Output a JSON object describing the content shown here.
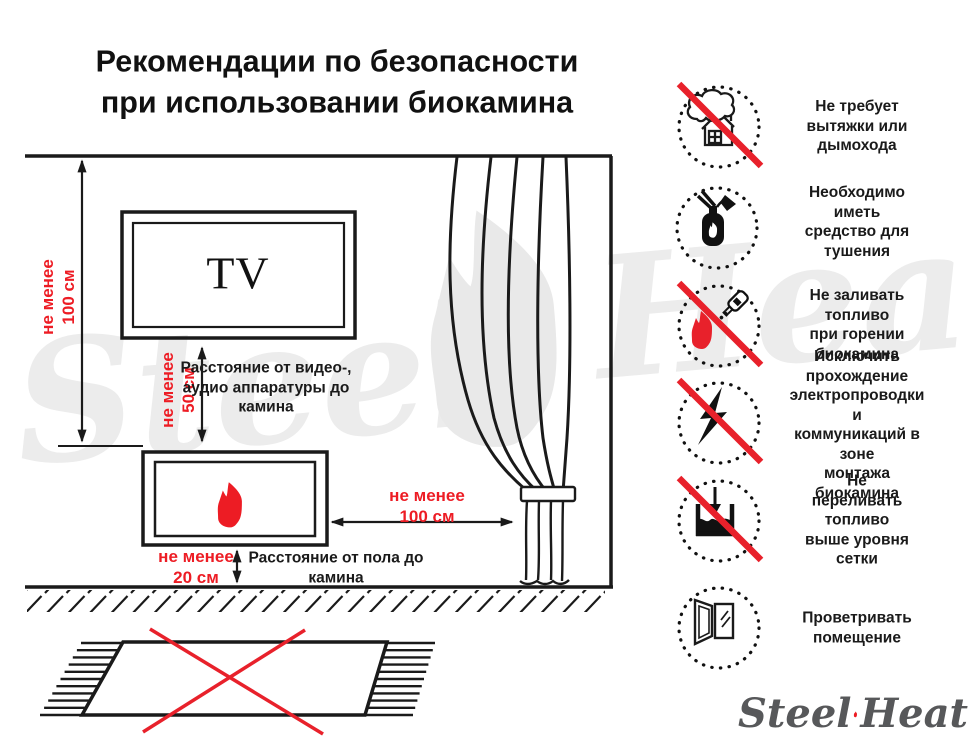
{
  "title": {
    "line1": "Рекомендации по безопасности",
    "line2": "при использовании биокамина"
  },
  "diagram": {
    "tv_label": "TV",
    "dim_wall_top": "не менее\n100 см",
    "dim_tv_gap": "не менее\n50 см",
    "caption_tv_gap": "Расстояние от видео-,\nаудио аппаратуры до\nкамина",
    "dim_curtain_gap": "не менее\n100 см",
    "dim_floor_gap": "не менее\n20 см",
    "caption_floor_gap": "Расстояние от пола до\nкамина"
  },
  "rules": [
    {
      "icon": "no-chimney-icon",
      "crossed": true,
      "text": "Не требует\nвытяжки или дымохода"
    },
    {
      "icon": "extinguisher-icon",
      "crossed": false,
      "text": "Необходимо иметь\nсредство для тушения"
    },
    {
      "icon": "no-refill-while-burning-icon",
      "crossed": true,
      "text": "Не заливать топливо\nпри горении биокамина"
    },
    {
      "icon": "no-wiring-icon",
      "crossed": true,
      "text": "Исключить прохождение\nэлектропроводки и\nкоммуникаций в зоне\nмонтажа биокамина"
    },
    {
      "icon": "no-overfill-icon",
      "crossed": true,
      "text": "Не переливать топливо\nвыше уровня сетки"
    },
    {
      "icon": "ventilate-icon",
      "crossed": false,
      "text": "Проветривать\nпомещение"
    }
  ],
  "watermark": {
    "steel": "Steel",
    "heat": "Heat"
  },
  "logo": {
    "steel": "Steel",
    "heat": "Heat"
  },
  "colors": {
    "red_accent": "#e8212b",
    "flame_red": "#ed1c24",
    "line_black": "#1a1a1a",
    "logo_gray": "#57585a",
    "watermark_gray": "#ececec"
  }
}
